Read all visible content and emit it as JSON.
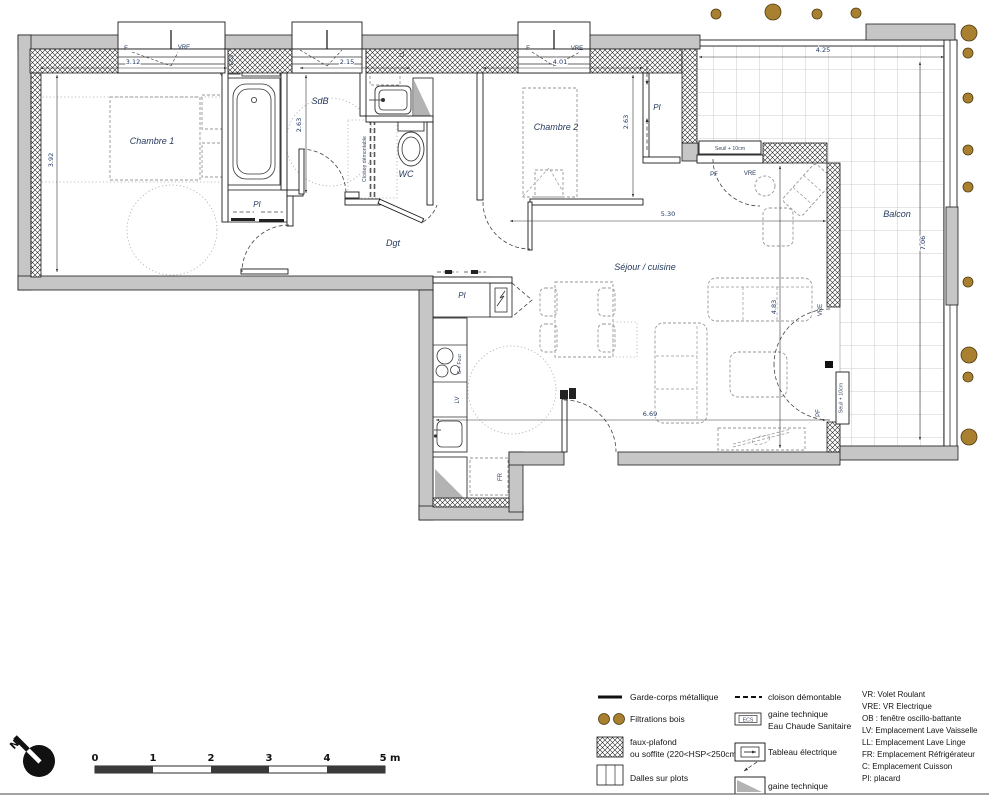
{
  "plan": {
    "rooms": {
      "chambre1": "Chambre 1",
      "sdb": "SdB",
      "wc": "WC",
      "chambre2": "Chambre 2",
      "dgt": "Dgt",
      "sejour": "Séjour / cuisine",
      "balcon": "Balcon"
    },
    "closet_label": "PI",
    "dims": {
      "ch1_width": "3.12",
      "ch1_depth": "3.92",
      "sdb_width": "2.15",
      "sdb_depth": "2.63",
      "ch2_width": "4.01",
      "ch2_depth": "2.63",
      "sejour_width": "5.30",
      "sejour_length": "6.69",
      "sejour_depth": "4.83",
      "balcon_width": "4.25",
      "balcon_length": "7.06"
    },
    "tags": {
      "f": "F",
      "vre": "VRE",
      "pf": "PF",
      "ecs": "ECS",
      "ll": "LL",
      "lv": "LV",
      "fr": "FR",
      "cooking": "C + Four",
      "seuil": "Seuil + 10cm",
      "cloison": "Cloison démontable",
      "north": "N"
    }
  },
  "scalebar": {
    "t0": "0",
    "t1": "1",
    "t2": "2",
    "t3": "3",
    "t4": "4",
    "t5": "5 m"
  },
  "legend": {
    "left": [
      {
        "label": "Garde-corps métallique"
      },
      {
        "label": "Filtrations bois"
      },
      {
        "label": "faux-plafond",
        "label2": "ou soffite (220<HSP<250cm)"
      },
      {
        "label": "Dalles sur plots"
      }
    ],
    "right": [
      {
        "label": "cloison démontable"
      },
      {
        "label": "gaine technique",
        "label2": "Eau Chaude Sanitaire",
        "swatch_text": "ECS"
      },
      {
        "label": "Tableau électrique"
      },
      {
        "label": "gaine technique"
      }
    ],
    "abbreviations": [
      "VR: Volet Roulant",
      "VRE: VR Electrique",
      "OB : fenêtre oscillo-battante",
      "LV: Emplacement Lave Vaisselle",
      "LL: Emplacement Lave Linge",
      "FR: Emplacement Réfrigérateur",
      "C: Emplacement Cuisson",
      "PI: placard"
    ]
  },
  "colors": {
    "wall": "#c6c6c6",
    "wood_dot": "#a8802f",
    "dim_text": "#1f3864"
  }
}
